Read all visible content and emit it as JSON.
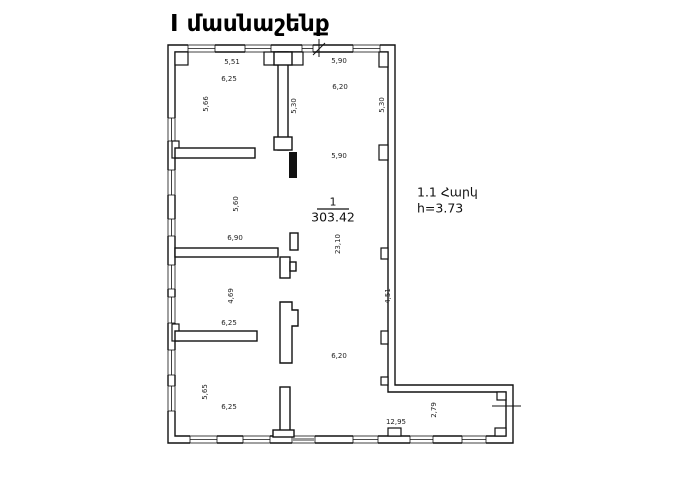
{
  "title": "I մասնաշենք",
  "floor_note": {
    "line1": "1.1 Հարկ",
    "line2": "h=3.73"
  },
  "room_stamp": {
    "number": "1",
    "area": "303.42"
  },
  "colors": {
    "wall": "#111111",
    "dim_text": "#222222",
    "background": "#ffffff"
  },
  "dimensions": [
    {
      "text": "5,51",
      "x": 232,
      "y": 62,
      "rot": 0
    },
    {
      "text": "6,25",
      "x": 229,
      "y": 79,
      "rot": 0
    },
    {
      "text": "5,66",
      "x": 206,
      "y": 104,
      "rot": -90
    },
    {
      "text": "5,30",
      "x": 294,
      "y": 106,
      "rot": -90
    },
    {
      "text": "5,90",
      "x": 339,
      "y": 61,
      "rot": 0
    },
    {
      "text": "6,20",
      "x": 340,
      "y": 87,
      "rot": 0
    },
    {
      "text": "5,30",
      "x": 382,
      "y": 105,
      "rot": -90
    },
    {
      "text": "5,90",
      "x": 339,
      "y": 156,
      "rot": 0
    },
    {
      "text": "5,60",
      "x": 236,
      "y": 204,
      "rot": -90
    },
    {
      "text": "6,90",
      "x": 235,
      "y": 238,
      "rot": 0
    },
    {
      "text": "23,10",
      "x": 338,
      "y": 244,
      "rot": -90
    },
    {
      "text": "4,69",
      "x": 231,
      "y": 296,
      "rot": -90
    },
    {
      "text": "6,25",
      "x": 229,
      "y": 323,
      "rot": 0
    },
    {
      "text": "4,51",
      "x": 388,
      "y": 296,
      "rot": -90
    },
    {
      "text": "6,20",
      "x": 339,
      "y": 356,
      "rot": 0
    },
    {
      "text": "5,65",
      "x": 205,
      "y": 392,
      "rot": -90
    },
    {
      "text": "6,25",
      "x": 229,
      "y": 407,
      "rot": 0
    },
    {
      "text": "12,95",
      "x": 396,
      "y": 422,
      "rot": 0
    },
    {
      "text": "2,79",
      "x": 434,
      "y": 410,
      "rot": -90
    }
  ]
}
